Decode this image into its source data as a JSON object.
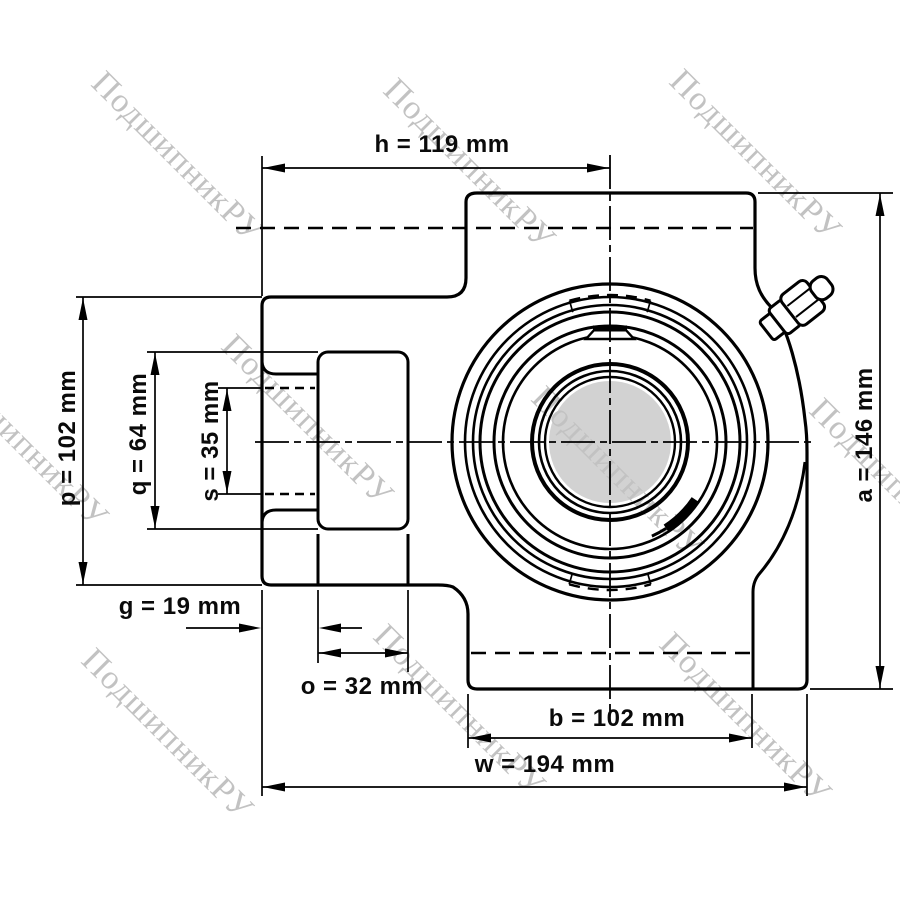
{
  "watermark": {
    "text": "ПодшипникРУ"
  },
  "dimensions": {
    "h": "h = 119 mm",
    "p": "p = 102 mm",
    "q": "q = 64 mm",
    "s": "s = 35 mm",
    "a": "a = 146 mm",
    "g": "g = 19 mm",
    "o": "o = 32 mm",
    "b": "b = 102 mm",
    "w": "w = 194 mm"
  },
  "colors": {
    "line": "#000000",
    "bore_fill": "#d2d2d2",
    "watermark": "#c2c2c2",
    "background": "#ffffff"
  }
}
